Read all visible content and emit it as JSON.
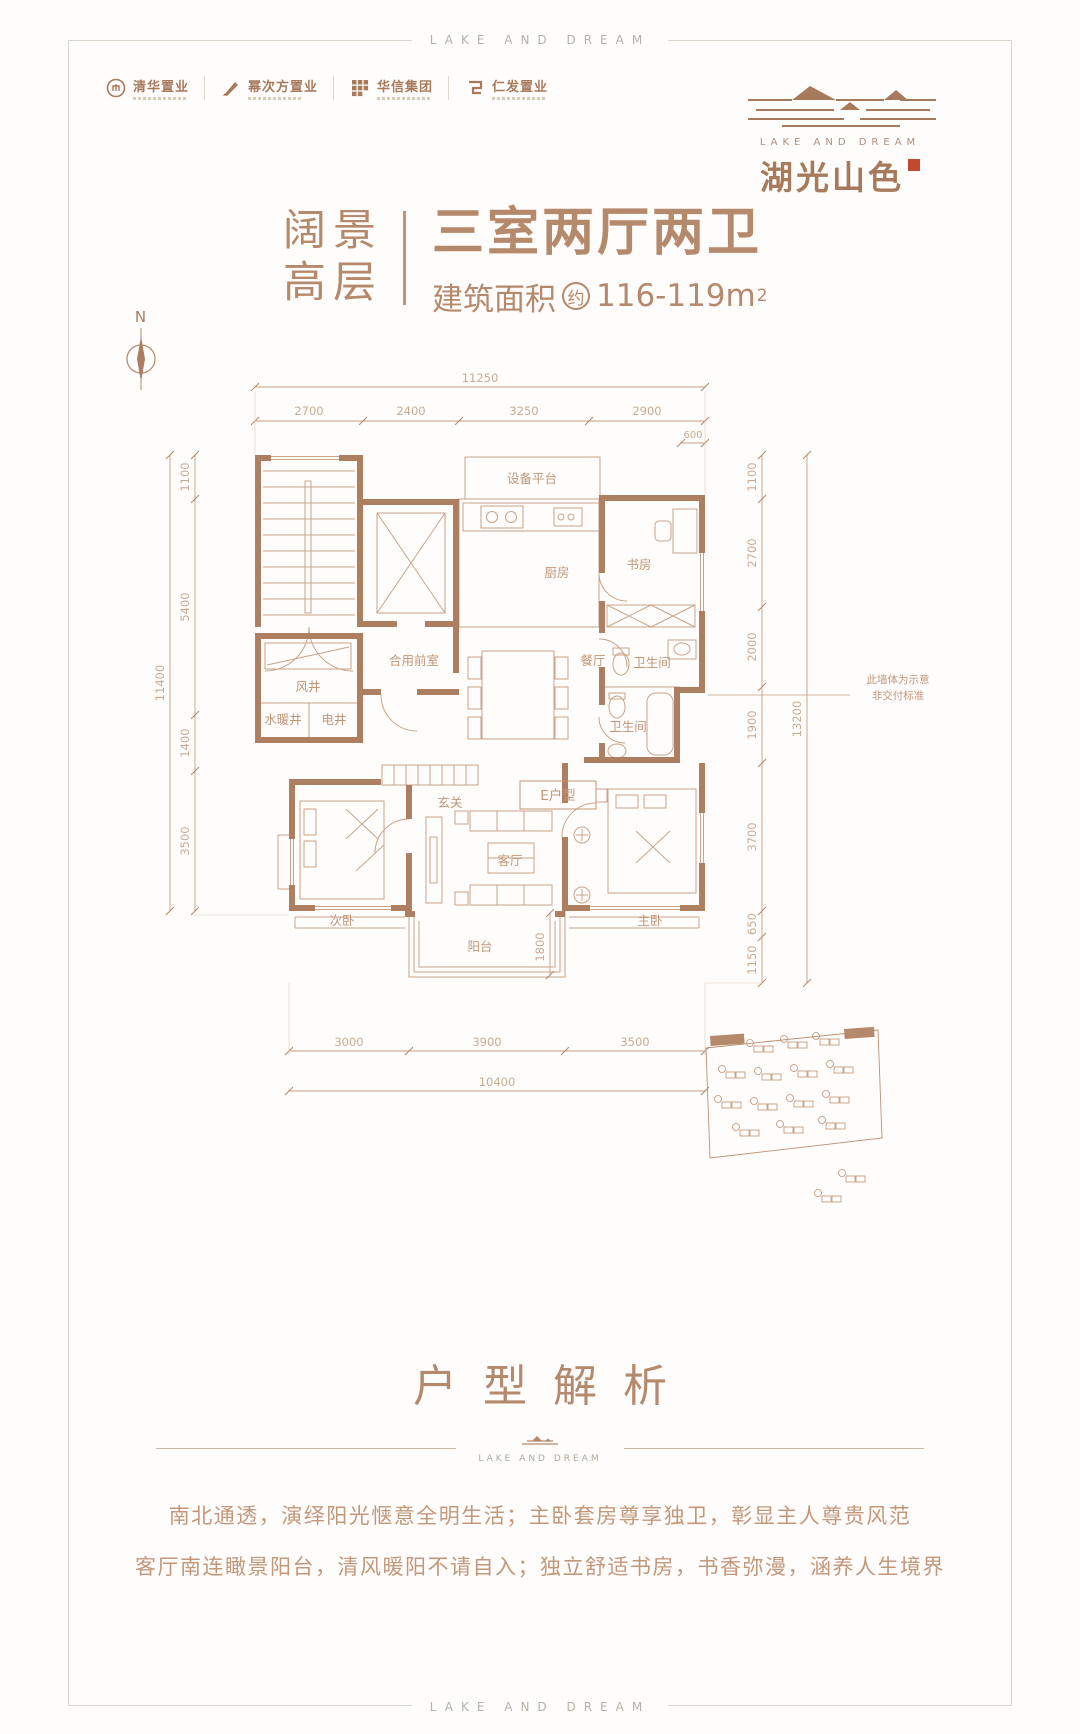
{
  "frame": {
    "top_text": "LAKE AND DREAM",
    "bottom_text": "LAKE AND DREAM"
  },
  "developers": [
    {
      "name": "清华置业"
    },
    {
      "name": "幂次方置业"
    },
    {
      "name": "华信集团"
    },
    {
      "name": "仁发置业"
    }
  ],
  "brand": {
    "english": "LAKE AND DREAM",
    "name": "湖光山色"
  },
  "header": {
    "tag_line1": "阔景",
    "tag_line2": "高层",
    "title": "三室两厅两卫",
    "area_label": "建筑面积",
    "area_approx": "约",
    "area_value": "116-119m",
    "area_sup": "2"
  },
  "compass": {
    "label": "N"
  },
  "floorplan": {
    "rooms": {
      "equipment": "设备平台",
      "kitchen": "厨房",
      "study": "书房",
      "dining": "餐厅",
      "front_room": "合用前室",
      "wind_shaft": "风井",
      "plumb_shaft": "水暖井",
      "elec_shaft": "电井",
      "entry": "玄关",
      "living": "客厅",
      "bedroom2": "次卧",
      "master": "主卧",
      "balcony": "阳台",
      "bath1": "卫生间",
      "bath2": "卫生间",
      "unit": "E户型"
    },
    "note_line1": "此墙体为示意",
    "note_line2": "非交付标准",
    "dims": {
      "top_total": "11250",
      "top_segments": [
        "2700",
        "2400",
        "3250",
        "2900"
      ],
      "top_offset": "600",
      "left_total": "11400",
      "left_segments": [
        "1100",
        "5400",
        "1400",
        "3500"
      ],
      "right_total": "13200",
      "right_segments": [
        "1100",
        "2700",
        "2000",
        "1900",
        "3700",
        "650",
        "1150"
      ],
      "bottom_total": "10400",
      "bottom_segments": [
        "3000",
        "3900",
        "3500"
      ],
      "balcony_depth": "1800"
    }
  },
  "section": {
    "title": "户型解析",
    "divider_text": "LAKE AND DREAM",
    "para1": "南北通透，演绎阳光惬意全明生活；主卧套房尊享独卫，彰显主人尊贵风范",
    "para2": "客厅南连瞰景阳台，清风暖阳不请自入；独立舒适书房，书香弥漫，涵养人生境界"
  }
}
